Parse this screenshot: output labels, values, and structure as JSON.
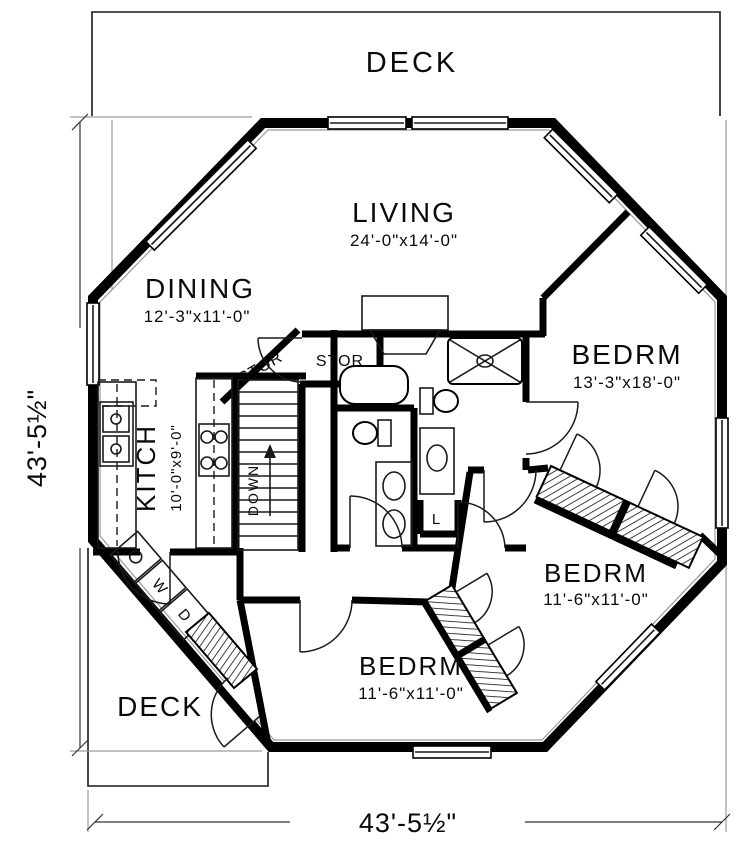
{
  "plan_title": "Octagonal House First Floor Plan",
  "labels": {
    "deck_top": "DECK",
    "deck_bottom": "DECK",
    "down": "DOWN",
    "linen": "L",
    "washer": "W",
    "dryer": "D",
    "stor_hall": "STOR",
    "stor_closet": "STOR"
  },
  "rooms": {
    "living": {
      "name": "LIVING",
      "dims": "24'-0\"x14'-0\""
    },
    "dining": {
      "name": "DINING",
      "dims": "12'-3\"x11'-0\""
    },
    "kitchen": {
      "name": "KITCH",
      "dims": "10'-0\"x9'-0\""
    },
    "bedroom_master": {
      "name": "BEDRM",
      "dims": "13'-3\"x18'-0\""
    },
    "bedroom_mid": {
      "name": "BEDRM",
      "dims": "11'-6\"x11'-0\""
    },
    "bedroom_bottom": {
      "name": "BEDRM",
      "dims": "11'-6\"x11'-0\""
    }
  },
  "dimensions": {
    "left": "43'-5½\"",
    "bottom": "43'-5½\""
  },
  "colors": {
    "ink": "#000000",
    "background": "#ffffff",
    "shadow_line": "#9a9a9a"
  }
}
